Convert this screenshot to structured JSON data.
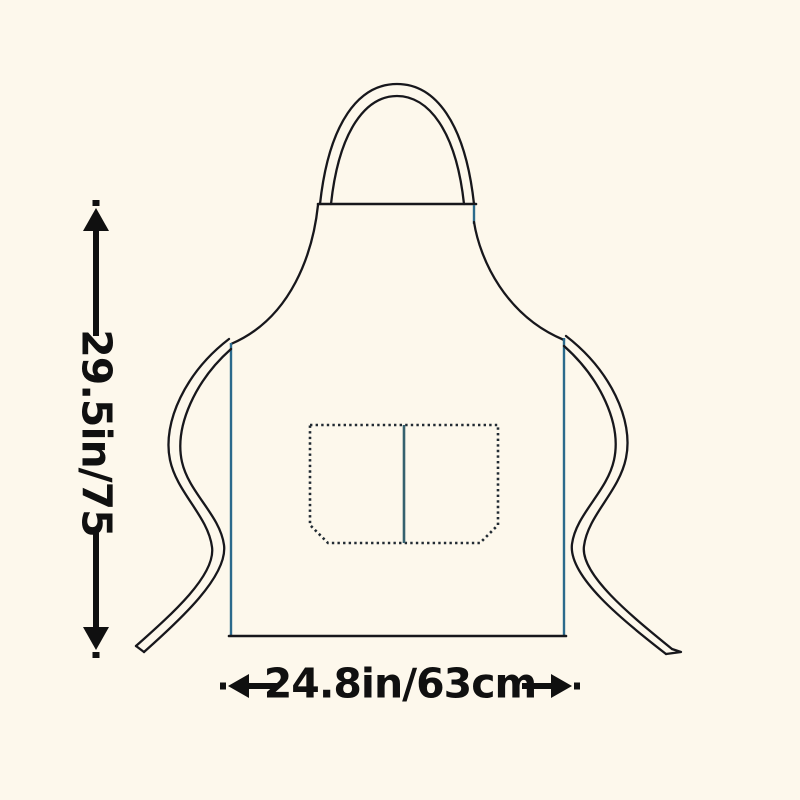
{
  "diagram": {
    "vertical_dimension": {
      "label": "29.5in/75"
    },
    "horizontal_dimension": {
      "label": "24.8in/63cm"
    },
    "colors": {
      "background": "#fdf8ec",
      "outline": "#17171c",
      "accent_blue": "#2b6a8c",
      "pocket_stitch": "#222b33",
      "pocket_divider": "#35616e",
      "text": "#101010"
    }
  }
}
